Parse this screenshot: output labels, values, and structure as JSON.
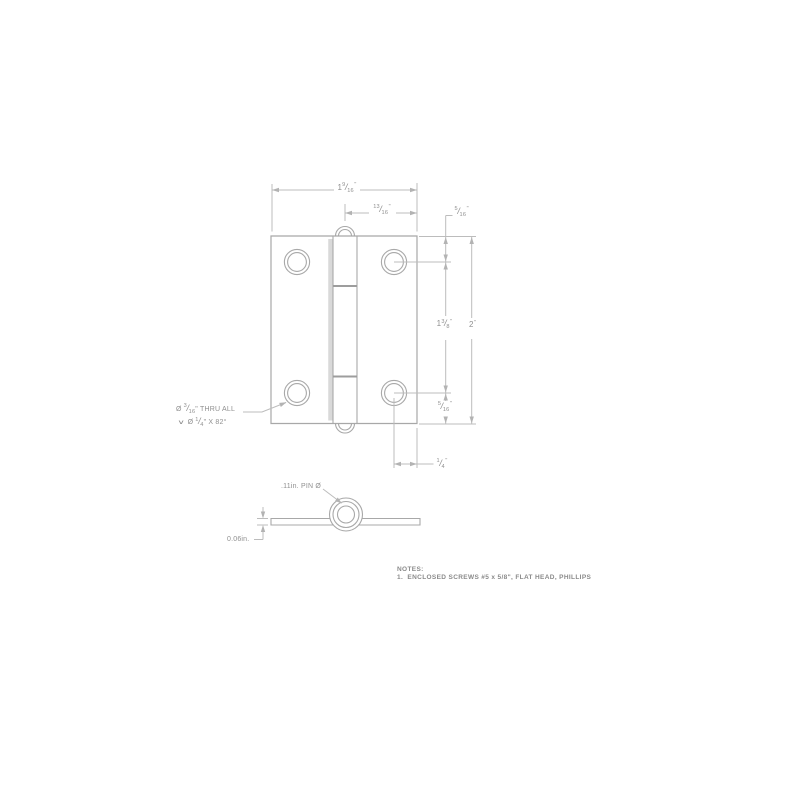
{
  "meta": {
    "background": "#ffffff",
    "drawing_line_color": "#a8a8a8",
    "dimension_line_color": "#bcbcbc",
    "text_color": "#8f8f8f",
    "fraction_slash": "/"
  },
  "front_view": {
    "dims": {
      "overall_width": {
        "whole": "1",
        "num": "9",
        "den": "16",
        "unit": "\""
      },
      "center_to_edge": {
        "whole": "",
        "num": "13",
        "den": "16",
        "unit": "\""
      },
      "top_hole_offset": {
        "whole": "",
        "num": "5",
        "den": "16",
        "unit": "\""
      },
      "hole_spacing": {
        "whole": "1",
        "num": "3",
        "den": "8",
        "unit": "\""
      },
      "overall_height": {
        "whole": "2",
        "unit": "\""
      },
      "bottom_hole_offset": {
        "whole": "",
        "num": "5",
        "den": "16",
        "unit": "\""
      },
      "hole_edge_offset": {
        "whole": "",
        "num": "1",
        "den": "4",
        "unit": "\""
      }
    },
    "hole_callout": {
      "line1_prefix": "Ø",
      "line1_num": "3",
      "line1_den": "16",
      "line1_suffix": "\" THRU ALL",
      "line2_symbol": "∨",
      "line2_prefix": "Ø",
      "line2_num": "1",
      "line2_den": "4",
      "line2_suffix": "\" X 82°"
    }
  },
  "side_view": {
    "pin_label": ".11in. PIN Ø",
    "thickness_label": "0.06in."
  },
  "notes": {
    "title": "NOTES:",
    "items": [
      "1.  ENCLOSED SCREWS #5 x 5/8\", FLAT HEAD, PHILLIPS"
    ]
  }
}
